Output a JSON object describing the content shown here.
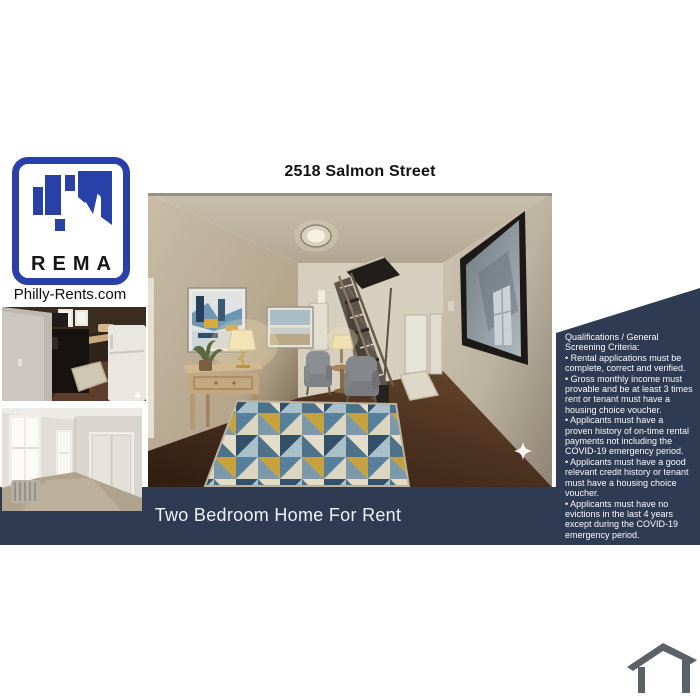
{
  "header": {
    "title": "2518 Salmon Street"
  },
  "branding": {
    "logo_text": "REMA",
    "website": "Philly-Rents.com"
  },
  "qualifications": {
    "heading": "Qualifications / General Screening Criteria:",
    "items": [
      "• Rental applications must be complete, correct and verified.",
      "• Gross monthly income must provable and be at least 3 times rent or tenant must have a housing choice voucher.",
      "• Applicants must have a proven history of on-time rental payments not including the COVID-19 emergency period.",
      "• Applicants must have a good relevant credit history or tenant must have a housing choice voucher.",
      "• Applicants must have no evictions in the last 4 years except during the COVID-19 emergency period."
    ]
  },
  "banner": {
    "text": "Two Bedroom Home For Rent"
  },
  "colors": {
    "panel-navy": "#2f3b53",
    "logo-blue": "#2840a7",
    "icon-gray": "#5a6268",
    "text-dark": "#121212"
  }
}
